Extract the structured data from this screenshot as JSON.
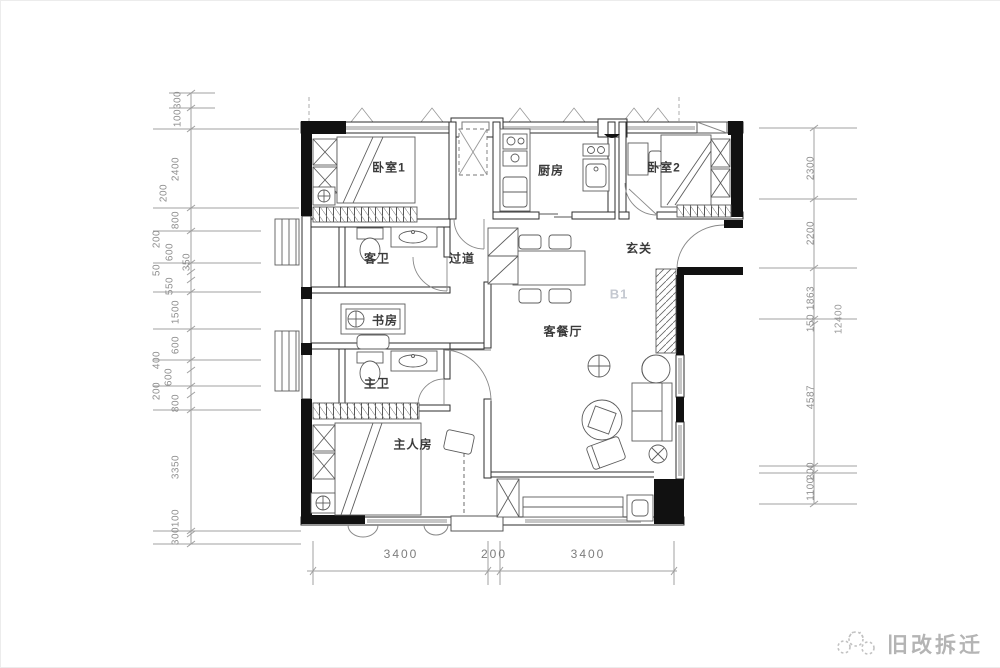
{
  "watermark": {
    "text": "旧改拆迁",
    "icon": "paw-logo",
    "color": "#b4b4b4"
  },
  "unit_label": {
    "text": "B1",
    "x": 618,
    "y": 293,
    "color": "#c4c8d0"
  },
  "rooms": [
    {
      "id": "bedroom-1",
      "label": "卧室1",
      "x": 388,
      "y": 166
    },
    {
      "id": "kitchen",
      "label": "厨房",
      "x": 550,
      "y": 169
    },
    {
      "id": "bedroom-2",
      "label": "卧室2",
      "x": 663,
      "y": 166
    },
    {
      "id": "guest-bath",
      "label": "客卫",
      "x": 376,
      "y": 257
    },
    {
      "id": "corridor",
      "label": "过道",
      "x": 461,
      "y": 257
    },
    {
      "id": "foyer",
      "label": "玄关",
      "x": 638,
      "y": 247
    },
    {
      "id": "study",
      "label": "书房",
      "x": 384,
      "y": 319
    },
    {
      "id": "living-dining",
      "label": "客餐厅",
      "x": 562,
      "y": 330
    },
    {
      "id": "master-bath",
      "label": "主卫",
      "x": 376,
      "y": 382
    },
    {
      "id": "master-bedroom",
      "label": "主人房",
      "x": 412,
      "y": 443
    }
  ],
  "dimensions": {
    "left": [
      {
        "label": "300",
        "x": 177,
        "y": 99
      },
      {
        "label": "100",
        "x": 177,
        "y": 117
      },
      {
        "label": "2400",
        "x": 175,
        "y": 168
      },
      {
        "label": "200",
        "x": 163,
        "y": 192
      },
      {
        "label": "800",
        "x": 175,
        "y": 219
      },
      {
        "label": "200",
        "x": 156,
        "y": 238
      },
      {
        "label": "600",
        "x": 169,
        "y": 251
      },
      {
        "label": "350",
        "x": 186,
        "y": 261
      },
      {
        "label": "50",
        "x": 156,
        "y": 269
      },
      {
        "label": "550",
        "x": 169,
        "y": 285
      },
      {
        "label": "1500",
        "x": 175,
        "y": 311
      },
      {
        "label": "600",
        "x": 175,
        "y": 344
      },
      {
        "label": "400",
        "x": 156,
        "y": 359
      },
      {
        "label": "600",
        "x": 168,
        "y": 376
      },
      {
        "label": "200",
        "x": 156,
        "y": 390
      },
      {
        "label": "800",
        "x": 175,
        "y": 402
      },
      {
        "label": "3350",
        "x": 175,
        "y": 466
      },
      {
        "label": "100",
        "x": 175,
        "y": 517
      },
      {
        "label": "300",
        "x": 175,
        "y": 535
      }
    ],
    "right": [
      {
        "label": "2300",
        "x": 810,
        "y": 167
      },
      {
        "label": "2200",
        "x": 810,
        "y": 232
      },
      {
        "label": "1863",
        "x": 810,
        "y": 297
      },
      {
        "label": "150",
        "x": 810,
        "y": 322
      },
      {
        "label": "4587",
        "x": 810,
        "y": 396
      },
      {
        "label": "200",
        "x": 810,
        "y": 470
      },
      {
        "label": "1100",
        "x": 810,
        "y": 488
      }
    ],
    "right_total": {
      "label": "12400",
      "x": 838,
      "y": 318
    },
    "bottom": [
      {
        "label": "3400",
        "x": 400,
        "y": 553
      },
      {
        "label": "200",
        "x": 493,
        "y": 553
      },
      {
        "label": "3400",
        "x": 587,
        "y": 553
      }
    ]
  }
}
